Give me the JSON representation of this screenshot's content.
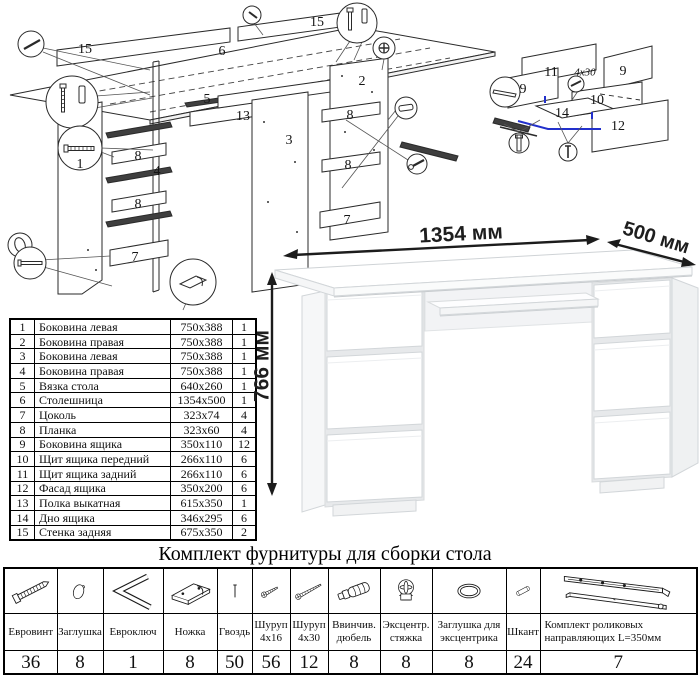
{
  "colors": {
    "accent_blue": "#2230cc",
    "diagram_line": "#222222",
    "desk_line": "#d3d6d9"
  },
  "exploded_views": {
    "desk_labels": [
      "15",
      "6",
      "15",
      "5",
      "2",
      "13",
      "8",
      "3",
      "1",
      "8",
      "4",
      "8",
      "7",
      "8",
      "7"
    ],
    "drawer_labels": [
      "11",
      "4x30",
      "9",
      "9",
      "10",
      "14",
      "12"
    ]
  },
  "parts_table": {
    "rows": [
      {
        "num": "1",
        "name": "Боковина левая",
        "size": "750x388",
        "qty": "1"
      },
      {
        "num": "2",
        "name": "Боковина правая",
        "size": "750x388",
        "qty": "1"
      },
      {
        "num": "3",
        "name": "Боковина левая",
        "size": "750x388",
        "qty": "1"
      },
      {
        "num": "4",
        "name": "Боковина правая",
        "size": "750x388",
        "qty": "1"
      },
      {
        "num": "5",
        "name": "Вязка стола",
        "size": "640x260",
        "qty": "1"
      },
      {
        "num": "6",
        "name": "Столешница",
        "size": "1354x500",
        "qty": "1"
      },
      {
        "num": "7",
        "name": "Цоколь",
        "size": "323x74",
        "qty": "4"
      },
      {
        "num": "8",
        "name": "Планка",
        "size": "323x60",
        "qty": "4"
      },
      {
        "num": "9",
        "name": "Боковина ящика",
        "size": "350x110",
        "qty": "12"
      },
      {
        "num": "10",
        "name": "Щит ящика передний",
        "size": "266x110",
        "qty": "6"
      },
      {
        "num": "11",
        "name": "Щит ящика задний",
        "size": "266x110",
        "qty": "6"
      },
      {
        "num": "12",
        "name": "Фасад ящика",
        "size": "350x200",
        "qty": "6"
      },
      {
        "num": "13",
        "name": "Полка выкатная",
        "size": "615x350",
        "qty": "1"
      },
      {
        "num": "14",
        "name": "Дно ящика",
        "size": "346x295",
        "qty": "6"
      },
      {
        "num": "15",
        "name": "Стенка задняя",
        "size": "675x350",
        "qty": "2"
      }
    ]
  },
  "dimensions": {
    "width": "1354 мм",
    "depth": "500 мм",
    "height": "766 мм"
  },
  "hardware": {
    "title": "Комплект фурнитуры для сборки стола",
    "items": [
      {
        "name": "Евровинт",
        "qty": "36",
        "icon": "confirmat-screw-icon"
      },
      {
        "name": "Заглушка",
        "qty": "8",
        "icon": "cap-icon"
      },
      {
        "name": "Евроключ",
        "qty": "1",
        "icon": "hex-key-icon"
      },
      {
        "name": "Ножка",
        "qty": "8",
        "icon": "foot-icon"
      },
      {
        "name": "Гвоздь",
        "qty": "50",
        "icon": "nail-icon"
      },
      {
        "name": "Шуруп 4x16",
        "qty": "56",
        "icon": "screw-short-icon"
      },
      {
        "name": "Шуруп 4x30",
        "qty": "12",
        "icon": "screw-long-icon"
      },
      {
        "name": "Ввинчив. дюбель",
        "qty": "8",
        "icon": "dowel-screw-icon"
      },
      {
        "name": "Эксцентр. стяжка",
        "qty": "8",
        "icon": "cam-lock-icon"
      },
      {
        "name": "Заглушка для эксцентрика",
        "qty": "8",
        "icon": "cam-cap-icon"
      },
      {
        "name": "Шкант",
        "qty": "24",
        "icon": "wooden-dowel-icon"
      },
      {
        "name": "Комплект роликовых направляющих L=350мм",
        "qty": "7",
        "icon": "drawer-slides-icon"
      }
    ]
  }
}
